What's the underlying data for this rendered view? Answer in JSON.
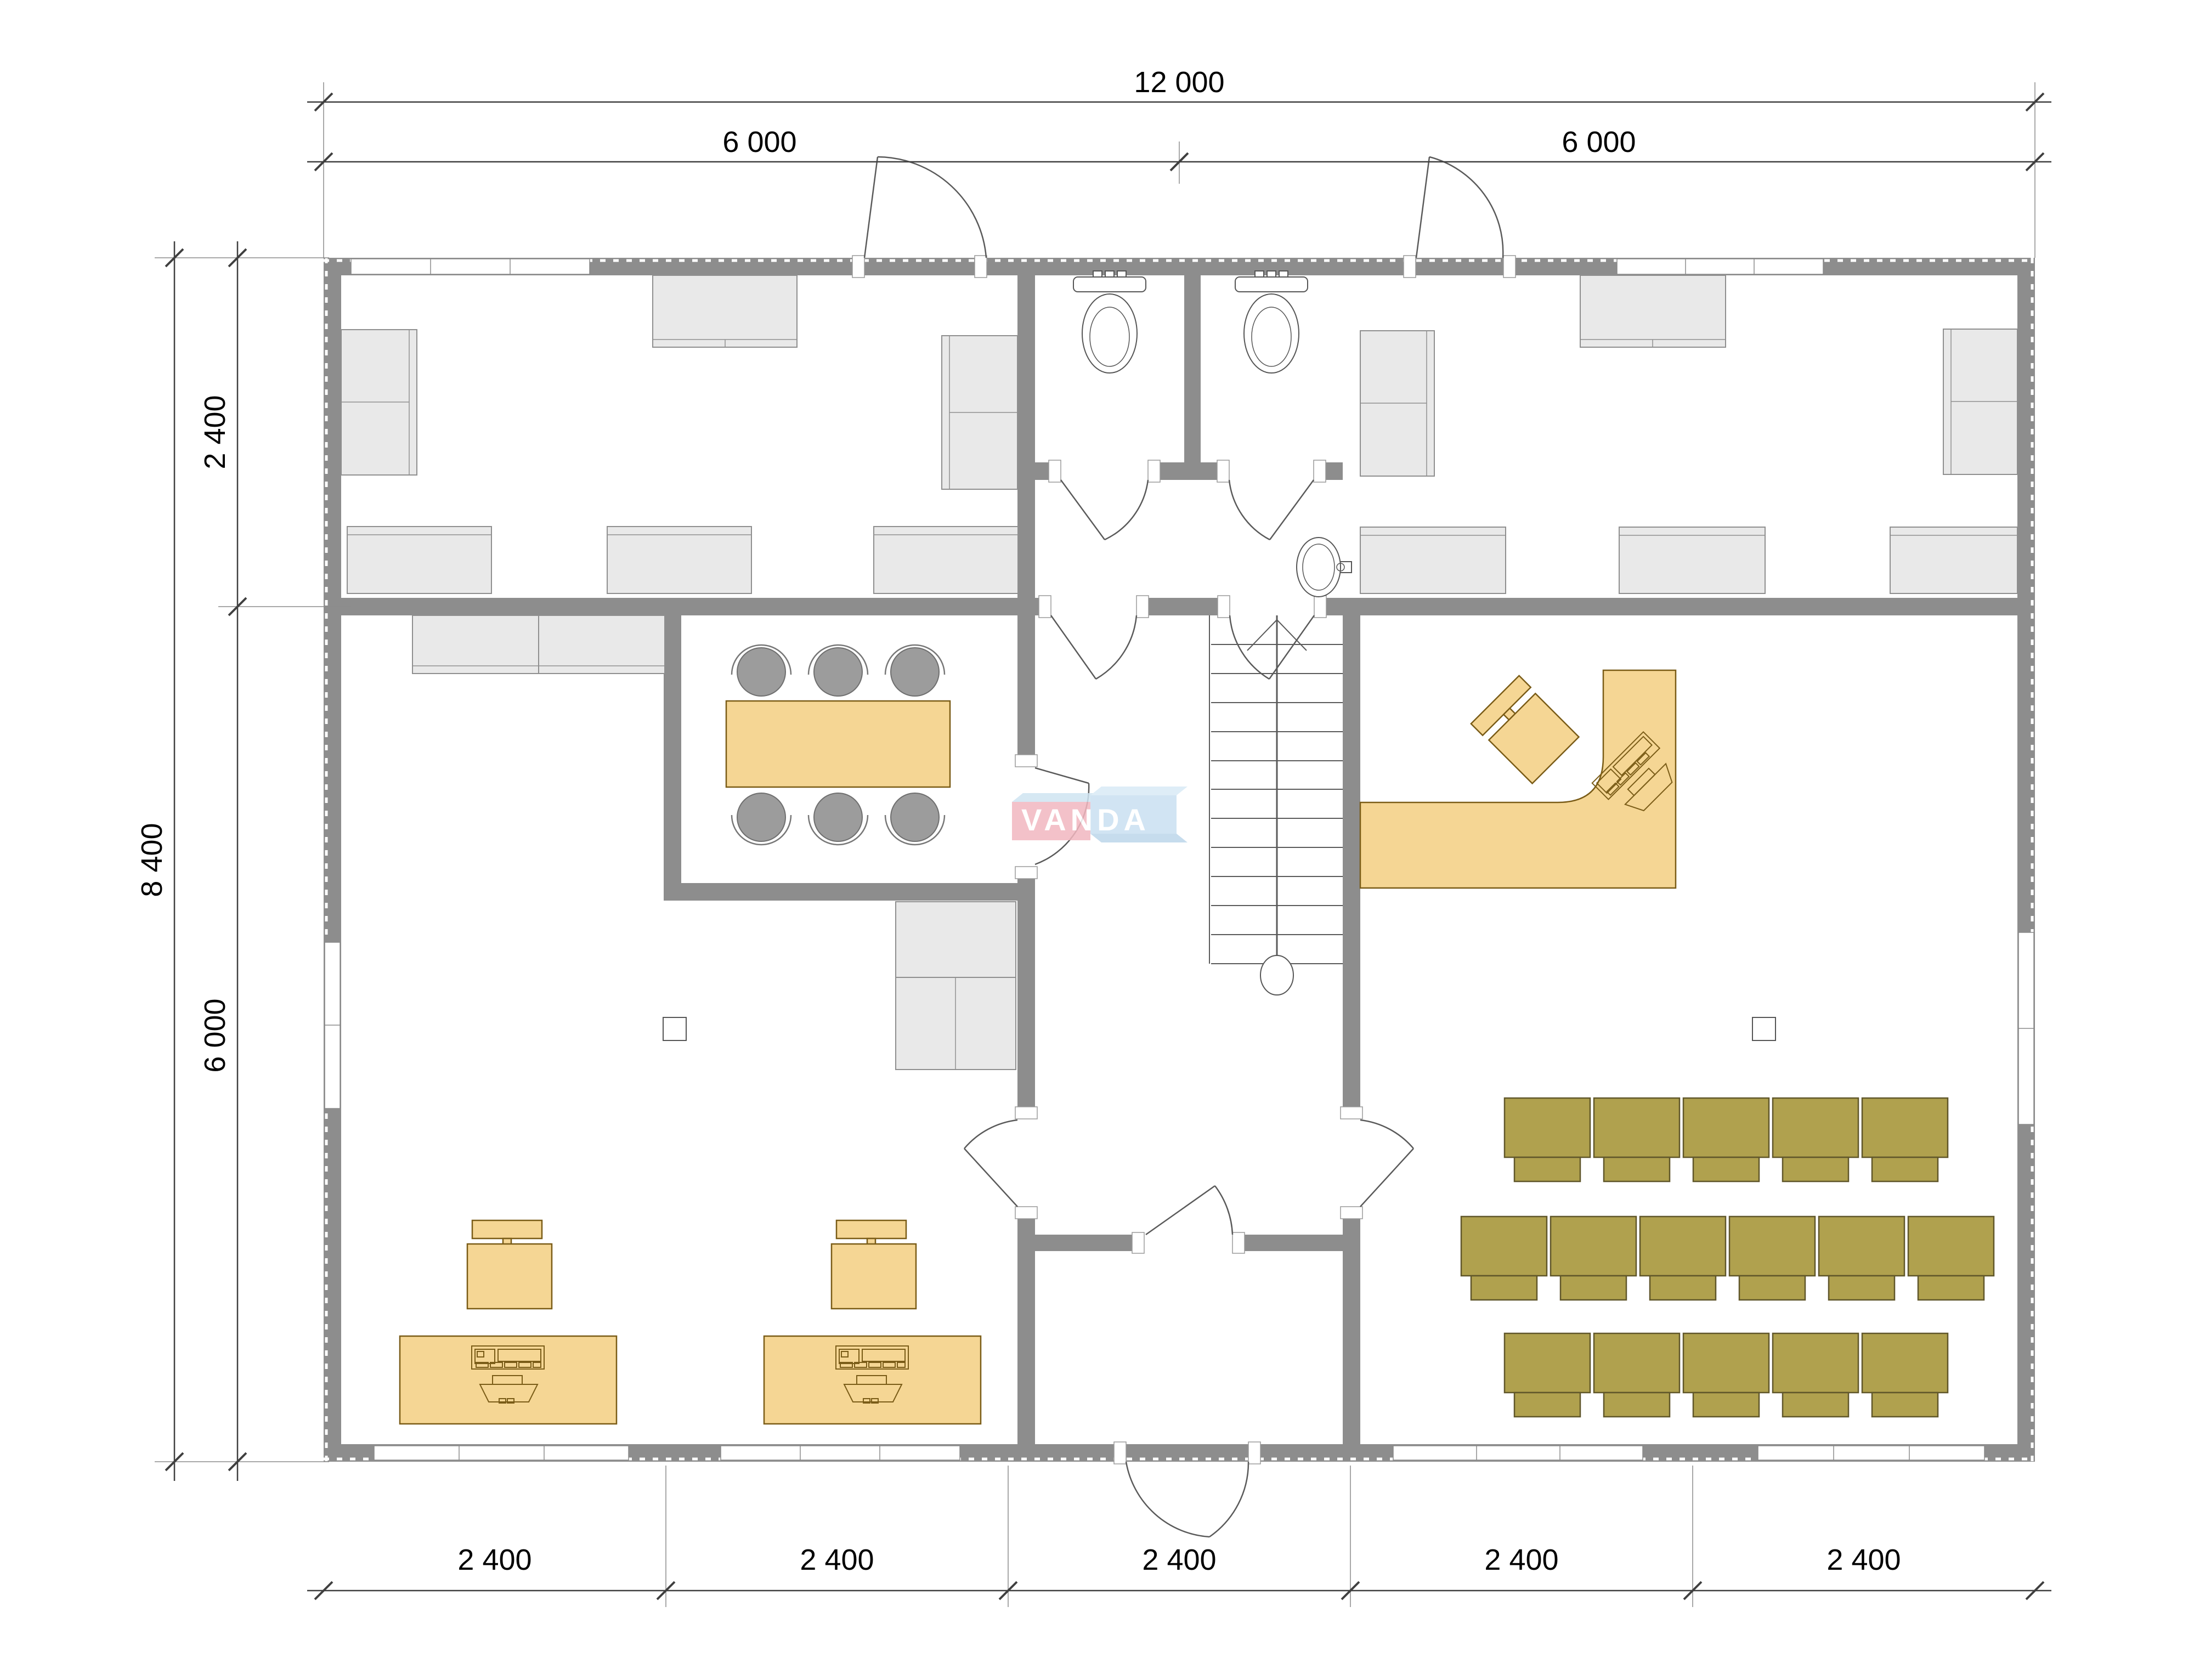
{
  "dimensions": {
    "top_total": "12 000",
    "top_halves": [
      "6 000",
      "6 000"
    ],
    "left": {
      "upper": "2 400",
      "total": "8 400",
      "lower": "6 000"
    },
    "bottom": [
      "2 400",
      "2 400",
      "2 400",
      "2 400",
      "2 400"
    ]
  },
  "watermark": {
    "text": "VANDA",
    "pink": "#f2b7c0",
    "blue": "#c9e0f1",
    "bevel_light": "#d9eaf6",
    "text_color": "#ffffff"
  },
  "colors": {
    "wall": "#8d8d8d",
    "light_furniture": "#e9e9e9",
    "wood_furniture": "#f5d694",
    "olive_chairs": "#b0a14e",
    "fixture_outline": "#555555"
  },
  "fixtures": {
    "toilets": 2,
    "sinks": 1,
    "stair_treads": 12,
    "meeting_chairs": 6,
    "meeting_tables": 1,
    "workstations": 2,
    "reception_desks": 1,
    "audience_rows": [
      5,
      6,
      5
    ]
  }
}
